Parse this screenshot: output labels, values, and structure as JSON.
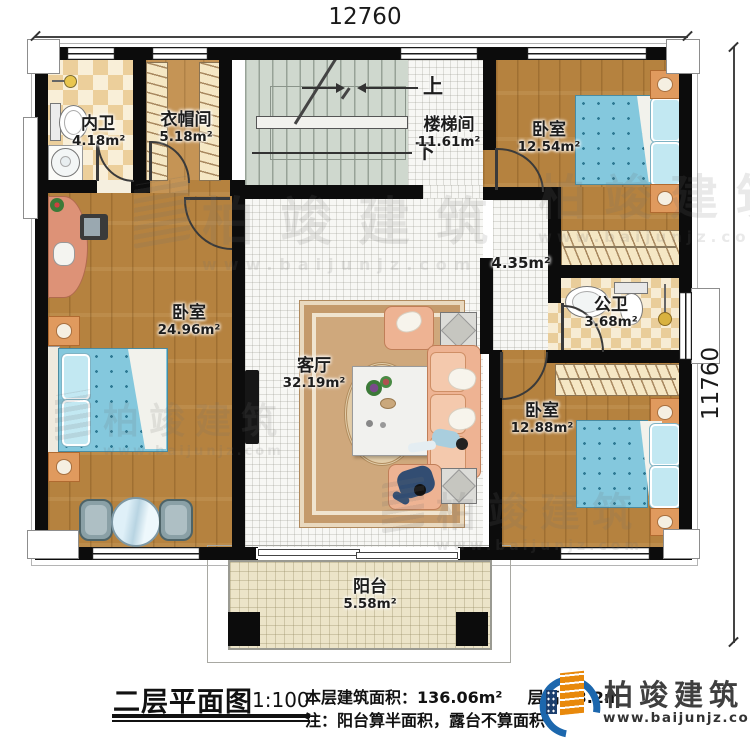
{
  "dimensions": {
    "top": "12760",
    "right": "11760"
  },
  "rooms": [
    {
      "name": "内卫",
      "area": "4.18m²"
    },
    {
      "name": "衣帽间",
      "area": "5.18m²"
    },
    {
      "name": "楼梯间",
      "area": "11.61m²"
    },
    {
      "name": "卧室",
      "area": "12.54m²"
    },
    {
      "name": "卧室",
      "area": "24.96m²"
    },
    {
      "name": "客厅",
      "area": "32.19m²"
    },
    {
      "name": "",
      "area": "4.35m²"
    },
    {
      "name": "公卫",
      "area": "3.68m²"
    },
    {
      "name": "卧室",
      "area": "12.88m²"
    },
    {
      "name": "阳台",
      "area": "5.58m²"
    }
  ],
  "stairs": {
    "up": "上",
    "down": "下"
  },
  "title_block": {
    "plan_title": "二层平面图",
    "scale": "1:100",
    "area_text": "本层建筑面积：136.06m²",
    "floor_height_text": "层高：3.2m",
    "note_text": "注：阳台算半面积，露台不算面积"
  },
  "brand": {
    "name": "柏竣建筑",
    "site": "www.baijunjz.com"
  },
  "watermark": {
    "text": "柏竣建筑",
    "site": "www.baijunjz.com"
  },
  "colors": {
    "wall": "#0c0c0c",
    "wood_floor": "#b5823f",
    "bath_checker": "#eccf9b",
    "stair_floor": "#cfd8ce",
    "balcony_floor": "#ece4c8",
    "mattress_blue": "#84c8dd",
    "sofa_salmon": "#eeb393",
    "logo_blue": "#1c67ad",
    "logo_orange": "#e8890c"
  }
}
